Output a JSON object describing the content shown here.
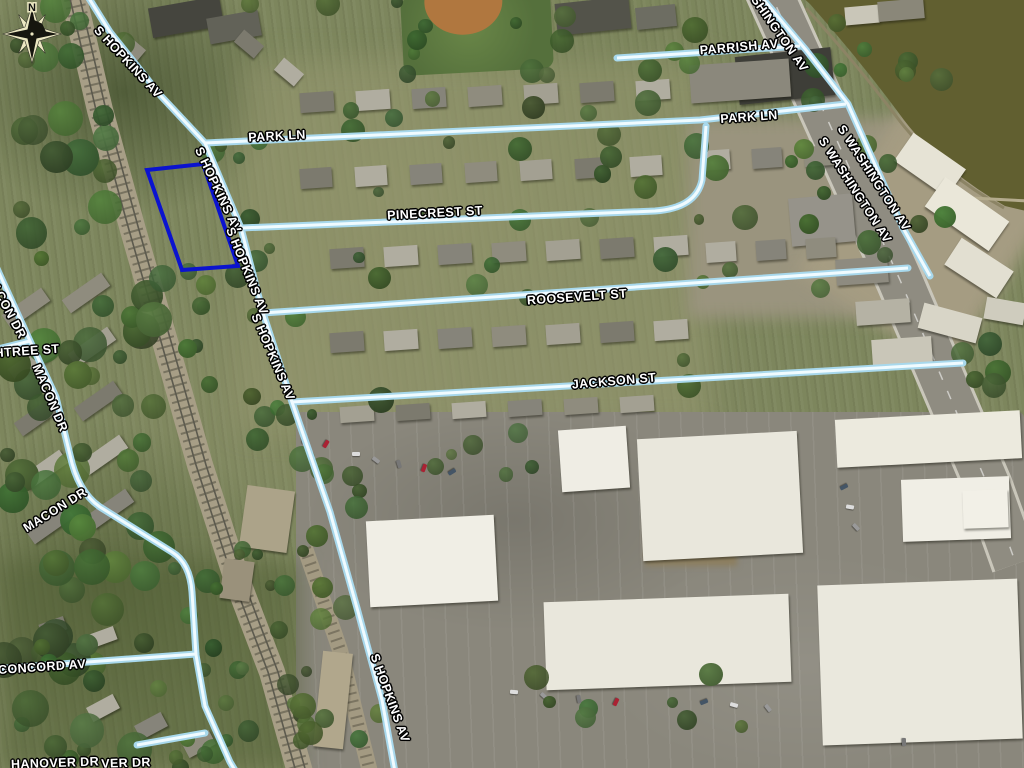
{
  "map": {
    "type": "aerial-parcel-map",
    "compass": {
      "letter": "N"
    },
    "parcel": {
      "outline_color": "#0b13cf",
      "polygon": [
        [
          147,
          170
        ],
        [
          203,
          164
        ],
        [
          238,
          266
        ],
        [
          182,
          270
        ]
      ]
    },
    "colors": {
      "road_highlight_core": "#f0fbff",
      "road_highlight_casing": "#a8d8ec",
      "water": "#615f30",
      "label_text": "#ffffff",
      "label_outline": "#000000",
      "railroad": "#a79e86",
      "major_road": "#8f8c81"
    },
    "street_labels": [
      {
        "text": "S HOPKINS AV",
        "x": 128,
        "y": 62,
        "angle": 47
      },
      {
        "text": "PARK LN",
        "x": 277,
        "y": 136,
        "angle": -3
      },
      {
        "text": "PARK LN",
        "x": 749,
        "y": 117,
        "angle": -4
      },
      {
        "text": "PARRISH AV",
        "x": 739,
        "y": 47,
        "angle": -5
      },
      {
        "text": "S WASHINGTON AV",
        "x": 770,
        "y": 20,
        "angle": 55
      },
      {
        "text": "S HOPKINS AV",
        "x": 218,
        "y": 190,
        "angle": 65
      },
      {
        "text": "S HOPKINS AV",
        "x": 247,
        "y": 271,
        "angle": 68
      },
      {
        "text": "S HOPKINS AV",
        "x": 273,
        "y": 357,
        "angle": 67
      },
      {
        "text": "PINECREST ST",
        "x": 435,
        "y": 213,
        "angle": -3
      },
      {
        "text": "ROOSEVELT ST",
        "x": 577,
        "y": 297,
        "angle": -4
      },
      {
        "text": "S WASHINGTON AV",
        "x": 874,
        "y": 178,
        "angle": 57
      },
      {
        "text": "S WASHINGTON AV",
        "x": 855,
        "y": 190,
        "angle": 57
      },
      {
        "text": "JACKSON ST",
        "x": 614,
        "y": 381,
        "angle": -5
      },
      {
        "text": "MACON DR",
        "x": 6,
        "y": 306,
        "angle": 62
      },
      {
        "text": "HTREE ST",
        "x": 27,
        "y": 351,
        "angle": -4
      },
      {
        "text": "MACON DR",
        "x": 50,
        "y": 398,
        "angle": 67
      },
      {
        "text": "MACON DR",
        "x": 55,
        "y": 510,
        "angle": -32
      },
      {
        "text": "CONCORD AV",
        "x": 42,
        "y": 667,
        "angle": -4
      },
      {
        "text": "S HOPKINS AV",
        "x": 390,
        "y": 698,
        "angle": 70
      },
      {
        "text": "HANOVER DR",
        "x": 55,
        "y": 763,
        "angle": -2
      },
      {
        "text": "VER DR",
        "x": 126,
        "y": 763,
        "angle": -2
      }
    ]
  }
}
